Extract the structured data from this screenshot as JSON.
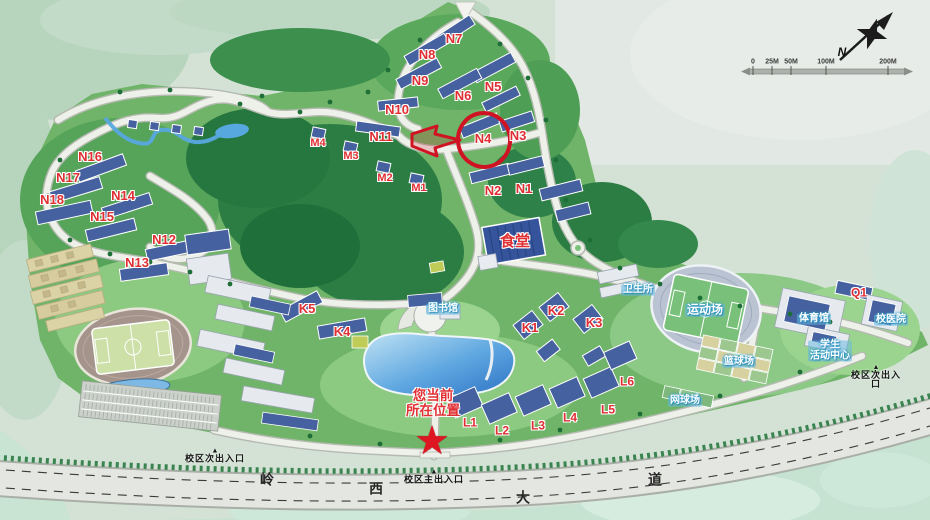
{
  "colors": {
    "label_red": "#e02f33",
    "label_cyan": "#2e9cc8",
    "star_red": "#dd1622",
    "annotation_red": "#d01323"
  },
  "legend": {
    "compass_label": "N",
    "scale_ticks": [
      {
        "text": "0",
        "x": 753,
        "y": 62
      },
      {
        "text": "25M",
        "x": 772,
        "y": 62
      },
      {
        "text": "50M",
        "x": 791,
        "y": 62
      },
      {
        "text": "100M",
        "x": 826,
        "y": 62
      },
      {
        "text": "200M",
        "x": 888,
        "y": 62
      }
    ]
  },
  "entrance_marker": "▲",
  "current_location": {
    "line1": "您当前",
    "line2": "所在位置",
    "star": "★"
  },
  "highlight": {
    "building": "N4",
    "style": "red-circle-with-arrow"
  },
  "road": {
    "name": "岭西大道"
  },
  "labels": {
    "building": [
      {
        "text": "N1",
        "x": 524,
        "y": 189
      },
      {
        "text": "N2",
        "x": 493,
        "y": 191
      },
      {
        "text": "N3",
        "x": 518,
        "y": 136
      },
      {
        "text": "N4",
        "x": 483,
        "y": 139
      },
      {
        "text": "N5",
        "x": 493,
        "y": 87
      },
      {
        "text": "N6",
        "x": 463,
        "y": 96
      },
      {
        "text": "N7",
        "x": 454,
        "y": 39
      },
      {
        "text": "N8",
        "x": 427,
        "y": 55
      },
      {
        "text": "N9",
        "x": 420,
        "y": 81
      },
      {
        "text": "N10",
        "x": 397,
        "y": 110
      },
      {
        "text": "N11",
        "x": 381,
        "y": 137
      },
      {
        "text": "N12",
        "x": 164,
        "y": 240
      },
      {
        "text": "N13",
        "x": 137,
        "y": 263
      },
      {
        "text": "N14",
        "x": 123,
        "y": 196
      },
      {
        "text": "N15",
        "x": 102,
        "y": 217
      },
      {
        "text": "N16",
        "x": 90,
        "y": 157
      },
      {
        "text": "N17",
        "x": 68,
        "y": 178
      },
      {
        "text": "N18",
        "x": 52,
        "y": 200
      },
      {
        "text": "M1",
        "x": 419,
        "y": 189,
        "size": 11
      },
      {
        "text": "M2",
        "x": 385,
        "y": 179,
        "size": 11
      },
      {
        "text": "M3",
        "x": 351,
        "y": 157,
        "size": 11
      },
      {
        "text": "M4",
        "x": 318,
        "y": 144,
        "size": 11
      },
      {
        "text": "K1",
        "x": 530,
        "y": 328
      },
      {
        "text": "K2",
        "x": 556,
        "y": 311
      },
      {
        "text": "K3",
        "x": 594,
        "y": 323
      },
      {
        "text": "K4",
        "x": 342,
        "y": 332
      },
      {
        "text": "K5",
        "x": 307,
        "y": 309
      },
      {
        "text": "L1",
        "x": 470,
        "y": 423,
        "size": 12
      },
      {
        "text": "L2",
        "x": 502,
        "y": 431,
        "size": 12
      },
      {
        "text": "L3",
        "x": 538,
        "y": 426,
        "size": 12
      },
      {
        "text": "L4",
        "x": 570,
        "y": 418,
        "size": 12
      },
      {
        "text": "L5",
        "x": 608,
        "y": 410,
        "size": 12
      },
      {
        "text": "L6",
        "x": 627,
        "y": 382,
        "size": 12
      },
      {
        "text": "Q1",
        "x": 859,
        "y": 293,
        "size": 12
      },
      {
        "text": "食堂",
        "x": 515,
        "y": 242,
        "size": 15
      }
    ],
    "facility": [
      {
        "text": "图书馆",
        "x": 443,
        "y": 309
      },
      {
        "text": "卫生所",
        "x": 638,
        "y": 290
      },
      {
        "text": "运动场",
        "x": 705,
        "y": 310,
        "size": 12
      },
      {
        "text": "篮球场",
        "x": 739,
        "y": 362
      },
      {
        "text": "网球场",
        "x": 685,
        "y": 401
      },
      {
        "text": "体育馆",
        "x": 814,
        "y": 319
      },
      {
        "text": "校医院",
        "x": 891,
        "y": 320
      },
      {
        "text": "学生\n活动中心",
        "x": 830,
        "y": 351
      }
    ],
    "entrances": [
      {
        "text": "校区次出入口",
        "x": 215,
        "y": 456
      },
      {
        "text": "校区主出入口",
        "x": 434,
        "y": 477
      },
      {
        "text": "校区次出入口",
        "x": 876,
        "y": 377
      }
    ],
    "road_chars": [
      {
        "text": "岭",
        "x": 267,
        "y": 480
      },
      {
        "text": "西",
        "x": 376,
        "y": 489
      },
      {
        "text": "大",
        "x": 523,
        "y": 498
      },
      {
        "text": "道",
        "x": 655,
        "y": 480
      }
    ]
  }
}
